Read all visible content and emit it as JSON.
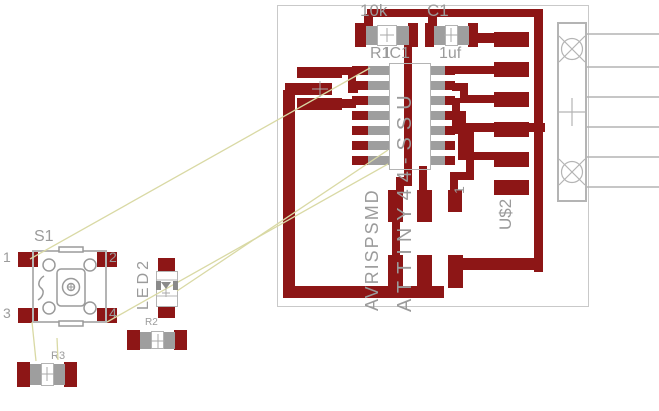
{
  "editor": {
    "view": "pcb-board-layout",
    "background": "#ffffff"
  },
  "colors": {
    "copper_top": "#8d1616",
    "pad_inner_gray": "#9e9e9e",
    "component_outline": "#b4b4b4",
    "label_text": "#9b9b9b",
    "airwire": "#d9d9a4",
    "board_outline": "#c9c9c9"
  },
  "components": {
    "r1": {
      "name": "R1",
      "value": "10k"
    },
    "c1": {
      "name": "C1",
      "value": "1uf"
    },
    "ic1": {
      "name": "IC1",
      "value": "ATTINY44-SSU"
    },
    "u2": {
      "name": "U$2",
      "value": "AVRISPSMD",
      "pin_label": "1"
    },
    "s1": {
      "name": "S1",
      "pins": [
        "1",
        "2",
        "3",
        "4"
      ]
    },
    "led2": {
      "name": "LED2"
    },
    "r2": {
      "name": "R2"
    },
    "r3": {
      "name": "R3"
    }
  }
}
